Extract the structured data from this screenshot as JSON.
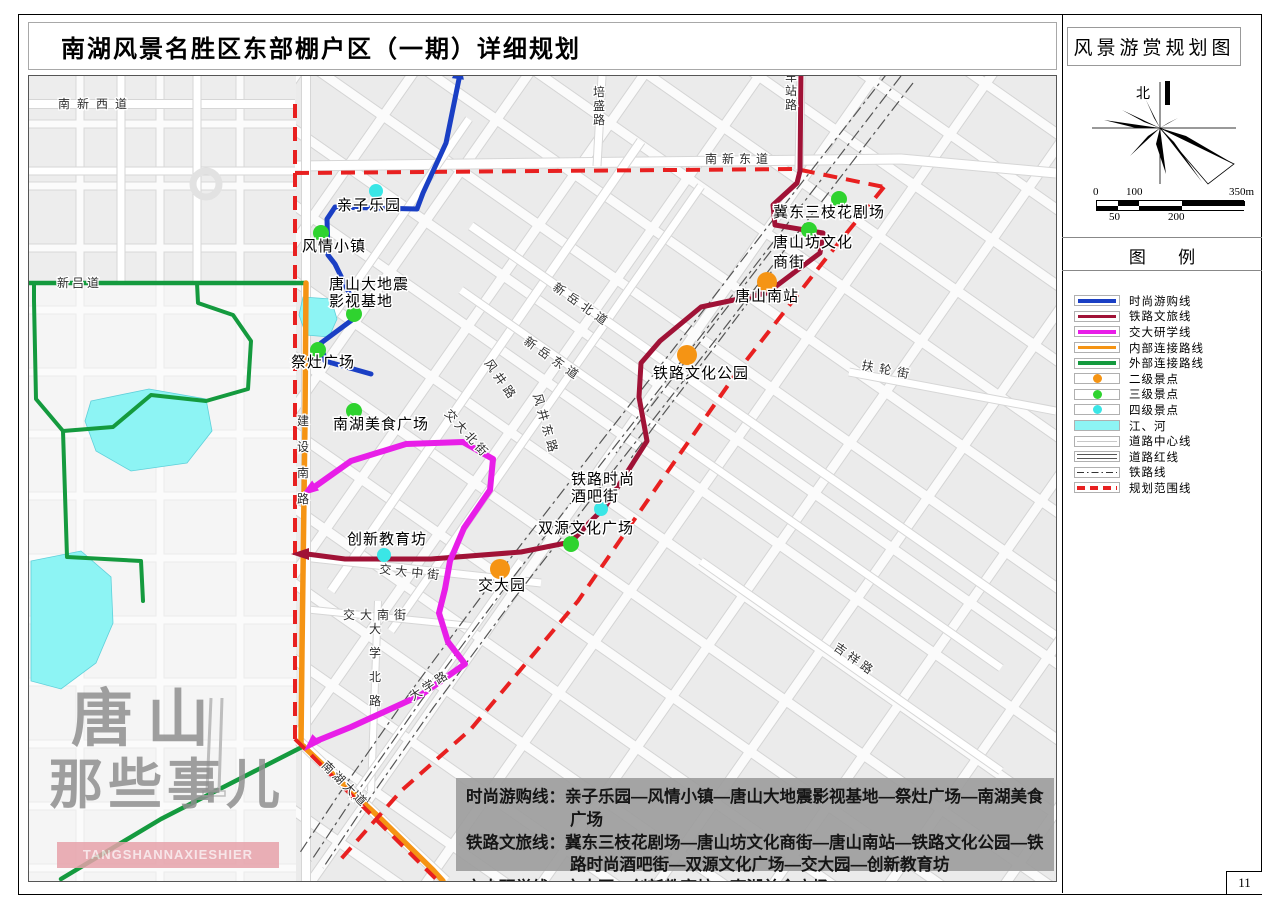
{
  "page": {
    "number": "11"
  },
  "header": {
    "title": "南湖风景名胜区东部棚户区（一期）详细规划",
    "map_name": "风景游赏规划图"
  },
  "compass": {
    "north_label": "北"
  },
  "scale_bar": {
    "top_labels": [
      "0",
      "100",
      "350m"
    ],
    "bottom_labels": [
      "50",
      "200"
    ]
  },
  "legend": {
    "title": "图 例",
    "items": [
      {
        "label": "时尚游购线",
        "type": "line",
        "color": "#1a3fc4"
      },
      {
        "label": "铁路文旅线",
        "type": "line",
        "color": "#a01236"
      },
      {
        "label": "交大研学线",
        "type": "line",
        "color": "#e81ee8"
      },
      {
        "label": "内部连接路线",
        "type": "line",
        "color": "#f59414"
      },
      {
        "label": "外部连接路线",
        "type": "line",
        "color": "#149a3e"
      },
      {
        "label": "二级景点",
        "type": "circle",
        "color": "#f59414"
      },
      {
        "label": "三级景点",
        "type": "circle",
        "color": "#2fd32f"
      },
      {
        "label": "四级景点",
        "type": "circle",
        "color": "#3ae6e6"
      },
      {
        "label": "江、河",
        "type": "water",
        "color": "#8df4f4"
      },
      {
        "label": "道路中心线",
        "type": "thin",
        "color": "#c8c8c8"
      },
      {
        "label": "道路红线",
        "type": "double",
        "color": "#555555"
      },
      {
        "label": "铁路线",
        "type": "dashdot",
        "color": "#333333"
      },
      {
        "label": "规划范围线",
        "type": "reddash",
        "color": "#e82020"
      }
    ]
  },
  "routes_box": {
    "lines": [
      {
        "label": "时尚游购线",
        "stops": "亲子乐园—风情小镇—唐山大地震影视基地—祭灶广场—南湖美食广场"
      },
      {
        "label": "铁路文旅线",
        "stops": "冀东三枝花剧场—唐山坊文化商街—唐山南站—铁路文化公园—铁路时尚酒吧街—双源文化广场—交大园—创新教育坊"
      },
      {
        "label": "交大研学线",
        "stops": "交大园—创新教育坊—南湖美食广场"
      }
    ]
  },
  "watermark": {
    "line1": "唐山",
    "line2": "那些事儿",
    "subtitle": "TANGSHANNAXIESHIER"
  },
  "colors": {
    "water": "#8df4f4",
    "boundary": "#e82020",
    "poi": {
      "2": "#f59414",
      "3": "#2fd32f",
      "4": "#3ae6e6"
    }
  },
  "map": {
    "lakes": [
      [
        [
          90,
          400
        ],
        [
          148,
          388
        ],
        [
          205,
          398
        ],
        [
          211,
          430
        ],
        [
          186,
          462
        ],
        [
          130,
          470
        ],
        [
          95,
          450
        ],
        [
          84,
          420
        ]
      ],
      [
        [
          30,
          560
        ],
        [
          80,
          550
        ],
        [
          110,
          576
        ],
        [
          112,
          622
        ],
        [
          95,
          662
        ],
        [
          60,
          688
        ],
        [
          30,
          680
        ]
      ],
      [
        [
          302,
          296
        ],
        [
          330,
          298
        ],
        [
          336,
          318
        ],
        [
          328,
          336
        ],
        [
          305,
          334
        ],
        [
          298,
          314
        ]
      ]
    ],
    "routes": [
      {
        "name": "external-connector-north",
        "label": "外部连接路线",
        "color": "#149a3e",
        "width": 4.5,
        "layer": "base",
        "points": [
          [
            28,
            282
          ],
          [
            305,
            282
          ]
        ]
      },
      {
        "name": "external-connector-loop",
        "label": "外部连接路线",
        "color": "#149a3e",
        "width": 4,
        "layer": "base",
        "points": [
          [
            196,
            282
          ],
          [
            197,
            302
          ],
          [
            232,
            314
          ],
          [
            250,
            340
          ],
          [
            247,
            388
          ],
          [
            205,
            400
          ],
          [
            150,
            394
          ],
          [
            112,
            426
          ],
          [
            62,
            430
          ],
          [
            35,
            398
          ],
          [
            33,
            300
          ],
          [
            33,
            284
          ]
        ]
      },
      {
        "name": "external-connector-west",
        "label": "外部连接路线",
        "color": "#149a3e",
        "width": 4,
        "layer": "base",
        "points": [
          [
            62,
            430
          ],
          [
            66,
            556
          ],
          [
            140,
            560
          ],
          [
            142,
            600
          ]
        ]
      },
      {
        "name": "external-connector-south",
        "label": "外部连接路线",
        "color": "#149a3e",
        "width": 4.5,
        "layer": "base",
        "points": [
          [
            60,
            878
          ],
          [
            160,
            818
          ],
          [
            250,
            772
          ],
          [
            303,
            745
          ]
        ]
      },
      {
        "name": "internal-connector",
        "label": "内部连接路线",
        "color": "#f59414",
        "width": 5.5,
        "layer": "base",
        "points": [
          [
            305,
            282
          ],
          [
            304,
            420
          ],
          [
            301,
            650
          ],
          [
            300,
            743
          ],
          [
            340,
            781
          ],
          [
            380,
            818
          ],
          [
            432,
            869
          ],
          [
            442,
            880
          ]
        ]
      },
      {
        "name": "fashion-shopping-line",
        "label": "时尚游购线",
        "color": "#1a3fc4",
        "width": 5,
        "layer": "top",
        "points": [
          [
            458,
            78
          ],
          [
            445,
            142
          ],
          [
            422,
            192
          ],
          [
            416,
            208
          ],
          [
            334,
            206
          ],
          [
            326,
            218
          ],
          [
            327,
            254
          ],
          [
            334,
            263
          ],
          [
            352,
            300
          ],
          [
            355,
            316
          ],
          [
            320,
            342
          ],
          [
            324,
            360
          ],
          [
            370,
            373
          ]
        ]
      },
      {
        "name": "railway-culture-line",
        "label": "铁路文旅线",
        "color": "#a01236",
        "width": 5,
        "layer": "top",
        "points": [
          [
            800,
            68
          ],
          [
            799,
            170
          ],
          [
            796,
            182
          ],
          [
            772,
            204
          ],
          [
            774,
            224
          ],
          [
            822,
            232
          ],
          [
            819,
            252
          ],
          [
            766,
            292
          ],
          [
            700,
            306
          ],
          [
            659,
            340
          ],
          [
            640,
            362
          ],
          [
            638,
            396
          ],
          [
            646,
            440
          ],
          [
            604,
            506
          ],
          [
            590,
            520
          ],
          [
            570,
            541
          ],
          [
            520,
            551
          ],
          [
            430,
            558
          ],
          [
            344,
            558
          ],
          [
            306,
            553
          ]
        ]
      },
      {
        "name": "jiaoda-study-line",
        "label": "交大研学线",
        "color": "#e81ee8",
        "width": 6,
        "layer": "top",
        "points": [
          [
            312,
            487
          ],
          [
            350,
            460
          ],
          [
            405,
            443
          ],
          [
            462,
            441
          ],
          [
            492,
            458
          ],
          [
            489,
            489
          ],
          [
            463,
            527
          ],
          [
            449,
            560
          ],
          [
            444,
            588
          ],
          [
            438,
            612
          ],
          [
            447,
            641
          ],
          [
            464,
            663
          ],
          [
            420,
            694
          ],
          [
            350,
            726
          ],
          [
            313,
            741
          ]
        ]
      }
    ],
    "arrows": [
      {
        "x": 458,
        "y": 70,
        "rot": 8,
        "color": "#1a3fc4"
      },
      {
        "x": 800,
        "y": 60,
        "rot": 0,
        "color": "#a01236"
      },
      {
        "x": 300,
        "y": 553,
        "rot": 270,
        "color": "#a01236"
      },
      {
        "x": 308,
        "y": 489,
        "rot": 235,
        "color": "#e81ee8"
      },
      {
        "x": 310,
        "y": 743,
        "rot": 225,
        "color": "#e81ee8"
      }
    ],
    "boundary": [
      [
        [
          294,
          103
        ],
        [
          294,
          738
        ]
      ],
      [
        [
          294,
          172
        ],
        [
          795,
          168
        ],
        [
          883,
          186
        ]
      ],
      [
        [
          883,
          186
        ],
        [
          823,
          260
        ],
        [
          737,
          370
        ],
        [
          660,
          480
        ],
        [
          577,
          600
        ],
        [
          470,
          728
        ],
        [
          400,
          790
        ],
        [
          340,
          858
        ]
      ],
      [
        [
          294,
          738
        ],
        [
          437,
          880
        ]
      ]
    ],
    "pois": [
      {
        "name": "亲子乐园",
        "level": 4,
        "x": 375,
        "y": 190,
        "labels": [
          {
            "t": "亲子乐园",
            "x": 336,
            "y": 209
          }
        ]
      },
      {
        "name": "风情小镇",
        "level": 3,
        "x": 320,
        "y": 232,
        "labels": [
          {
            "t": "风情小镇",
            "x": 301,
            "y": 250
          }
        ]
      },
      {
        "name": "唐山大地震影视基地",
        "level": 3,
        "x": 353,
        "y": 313,
        "labels": [
          {
            "t": "唐山大地震",
            "x": 328,
            "y": 288
          },
          {
            "t": "影视基地",
            "x": 328,
            "y": 305
          }
        ]
      },
      {
        "name": "祭灶广场",
        "level": 3,
        "x": 317,
        "y": 349,
        "labels": [
          {
            "t": "祭灶广场",
            "x": 290,
            "y": 366
          }
        ]
      },
      {
        "name": "南湖美食广场",
        "level": 3,
        "x": 353,
        "y": 410,
        "labels": [
          {
            "t": "南湖美食广场",
            "x": 332,
            "y": 428
          }
        ]
      },
      {
        "name": "冀东三枝花剧场",
        "level": 3,
        "x": 838,
        "y": 198,
        "labels": [
          {
            "t": "冀东三枝花剧场",
            "x": 772,
            "y": 216
          }
        ]
      },
      {
        "name": "唐山坊文化商街",
        "level": 3,
        "x": 808,
        "y": 229,
        "labels": [
          {
            "t": "唐山坊文化",
            "x": 772,
            "y": 246
          },
          {
            "t": "商街",
            "x": 772,
            "y": 266
          }
        ]
      },
      {
        "name": "唐山南站",
        "level": 2,
        "x": 766,
        "y": 281,
        "labels": [
          {
            "t": "唐山南站",
            "x": 734,
            "y": 300
          }
        ]
      },
      {
        "name": "铁路文化公园",
        "level": 2,
        "x": 686,
        "y": 354,
        "labels": [
          {
            "t": "铁路文化公园",
            "x": 652,
            "y": 377
          }
        ]
      },
      {
        "name": "铁路时尚酒吧街",
        "level": 4,
        "x": 600,
        "y": 508,
        "labels": [
          {
            "t": "铁路时尚",
            "x": 570,
            "y": 483
          },
          {
            "t": "酒吧街",
            "x": 570,
            "y": 500
          }
        ]
      },
      {
        "name": "双源文化广场",
        "level": 3,
        "x": 570,
        "y": 543,
        "labels": [
          {
            "t": "双源文化广场",
            "x": 537,
            "y": 532
          }
        ]
      },
      {
        "name": "创新教育坊",
        "level": 4,
        "x": 383,
        "y": 554,
        "labels": [
          {
            "t": "创新教育坊",
            "x": 346,
            "y": 543
          }
        ]
      },
      {
        "name": "交大园",
        "level": 2,
        "x": 499,
        "y": 568,
        "labels": [
          {
            "t": "交大园",
            "x": 477,
            "y": 589
          }
        ]
      }
    ],
    "streets": [
      {
        "t": "南新西道",
        "x": 57,
        "y": 107,
        "ls": 7
      },
      {
        "t": "南新东道",
        "x": 704,
        "y": 162,
        "ls": 5
      },
      {
        "t": "新吕道",
        "x": 56,
        "y": 286,
        "ls": 3
      },
      {
        "t": "培盛路",
        "x": 592,
        "y": 95,
        "vert": true
      },
      {
        "t": "车站路",
        "x": 784,
        "y": 80,
        "vert": true
      },
      {
        "t": "建设南路",
        "x": 296,
        "y": 424,
        "vert": true,
        "gap": 26
      },
      {
        "t": "大学北路",
        "x": 368,
        "y": 632,
        "vert": true,
        "gap": 24
      },
      {
        "t": "新岳北道",
        "x": 551,
        "y": 288,
        "rot": 35,
        "ls": 5
      },
      {
        "t": "新岳东道",
        "x": 522,
        "y": 342,
        "rot": 35,
        "ls": 5
      },
      {
        "t": "风井路",
        "x": 483,
        "y": 362,
        "rot": 55,
        "ls": 4
      },
      {
        "t": "风井东路",
        "x": 532,
        "y": 394,
        "rot": 74,
        "ls": 4
      },
      {
        "t": "扶轮街",
        "x": 860,
        "y": 368,
        "rot": 11,
        "ls": 6
      },
      {
        "t": "吉祥路",
        "x": 832,
        "y": 648,
        "rot": 35,
        "ls": 4
      },
      {
        "t": "交大北街",
        "x": 443,
        "y": 413,
        "rot": 48,
        "ls": 3
      },
      {
        "t": "交大中街",
        "x": 378,
        "y": 572,
        "rot": 6,
        "ls": 4
      },
      {
        "t": "交大南街",
        "x": 342,
        "y": 618,
        "ls": 5
      },
      {
        "t": "大学路",
        "x": 412,
        "y": 700,
        "rot": -33,
        "ls": 3
      },
      {
        "t": "南湖大道",
        "x": 320,
        "y": 765,
        "rot": 45,
        "ls": 3
      }
    ]
  }
}
